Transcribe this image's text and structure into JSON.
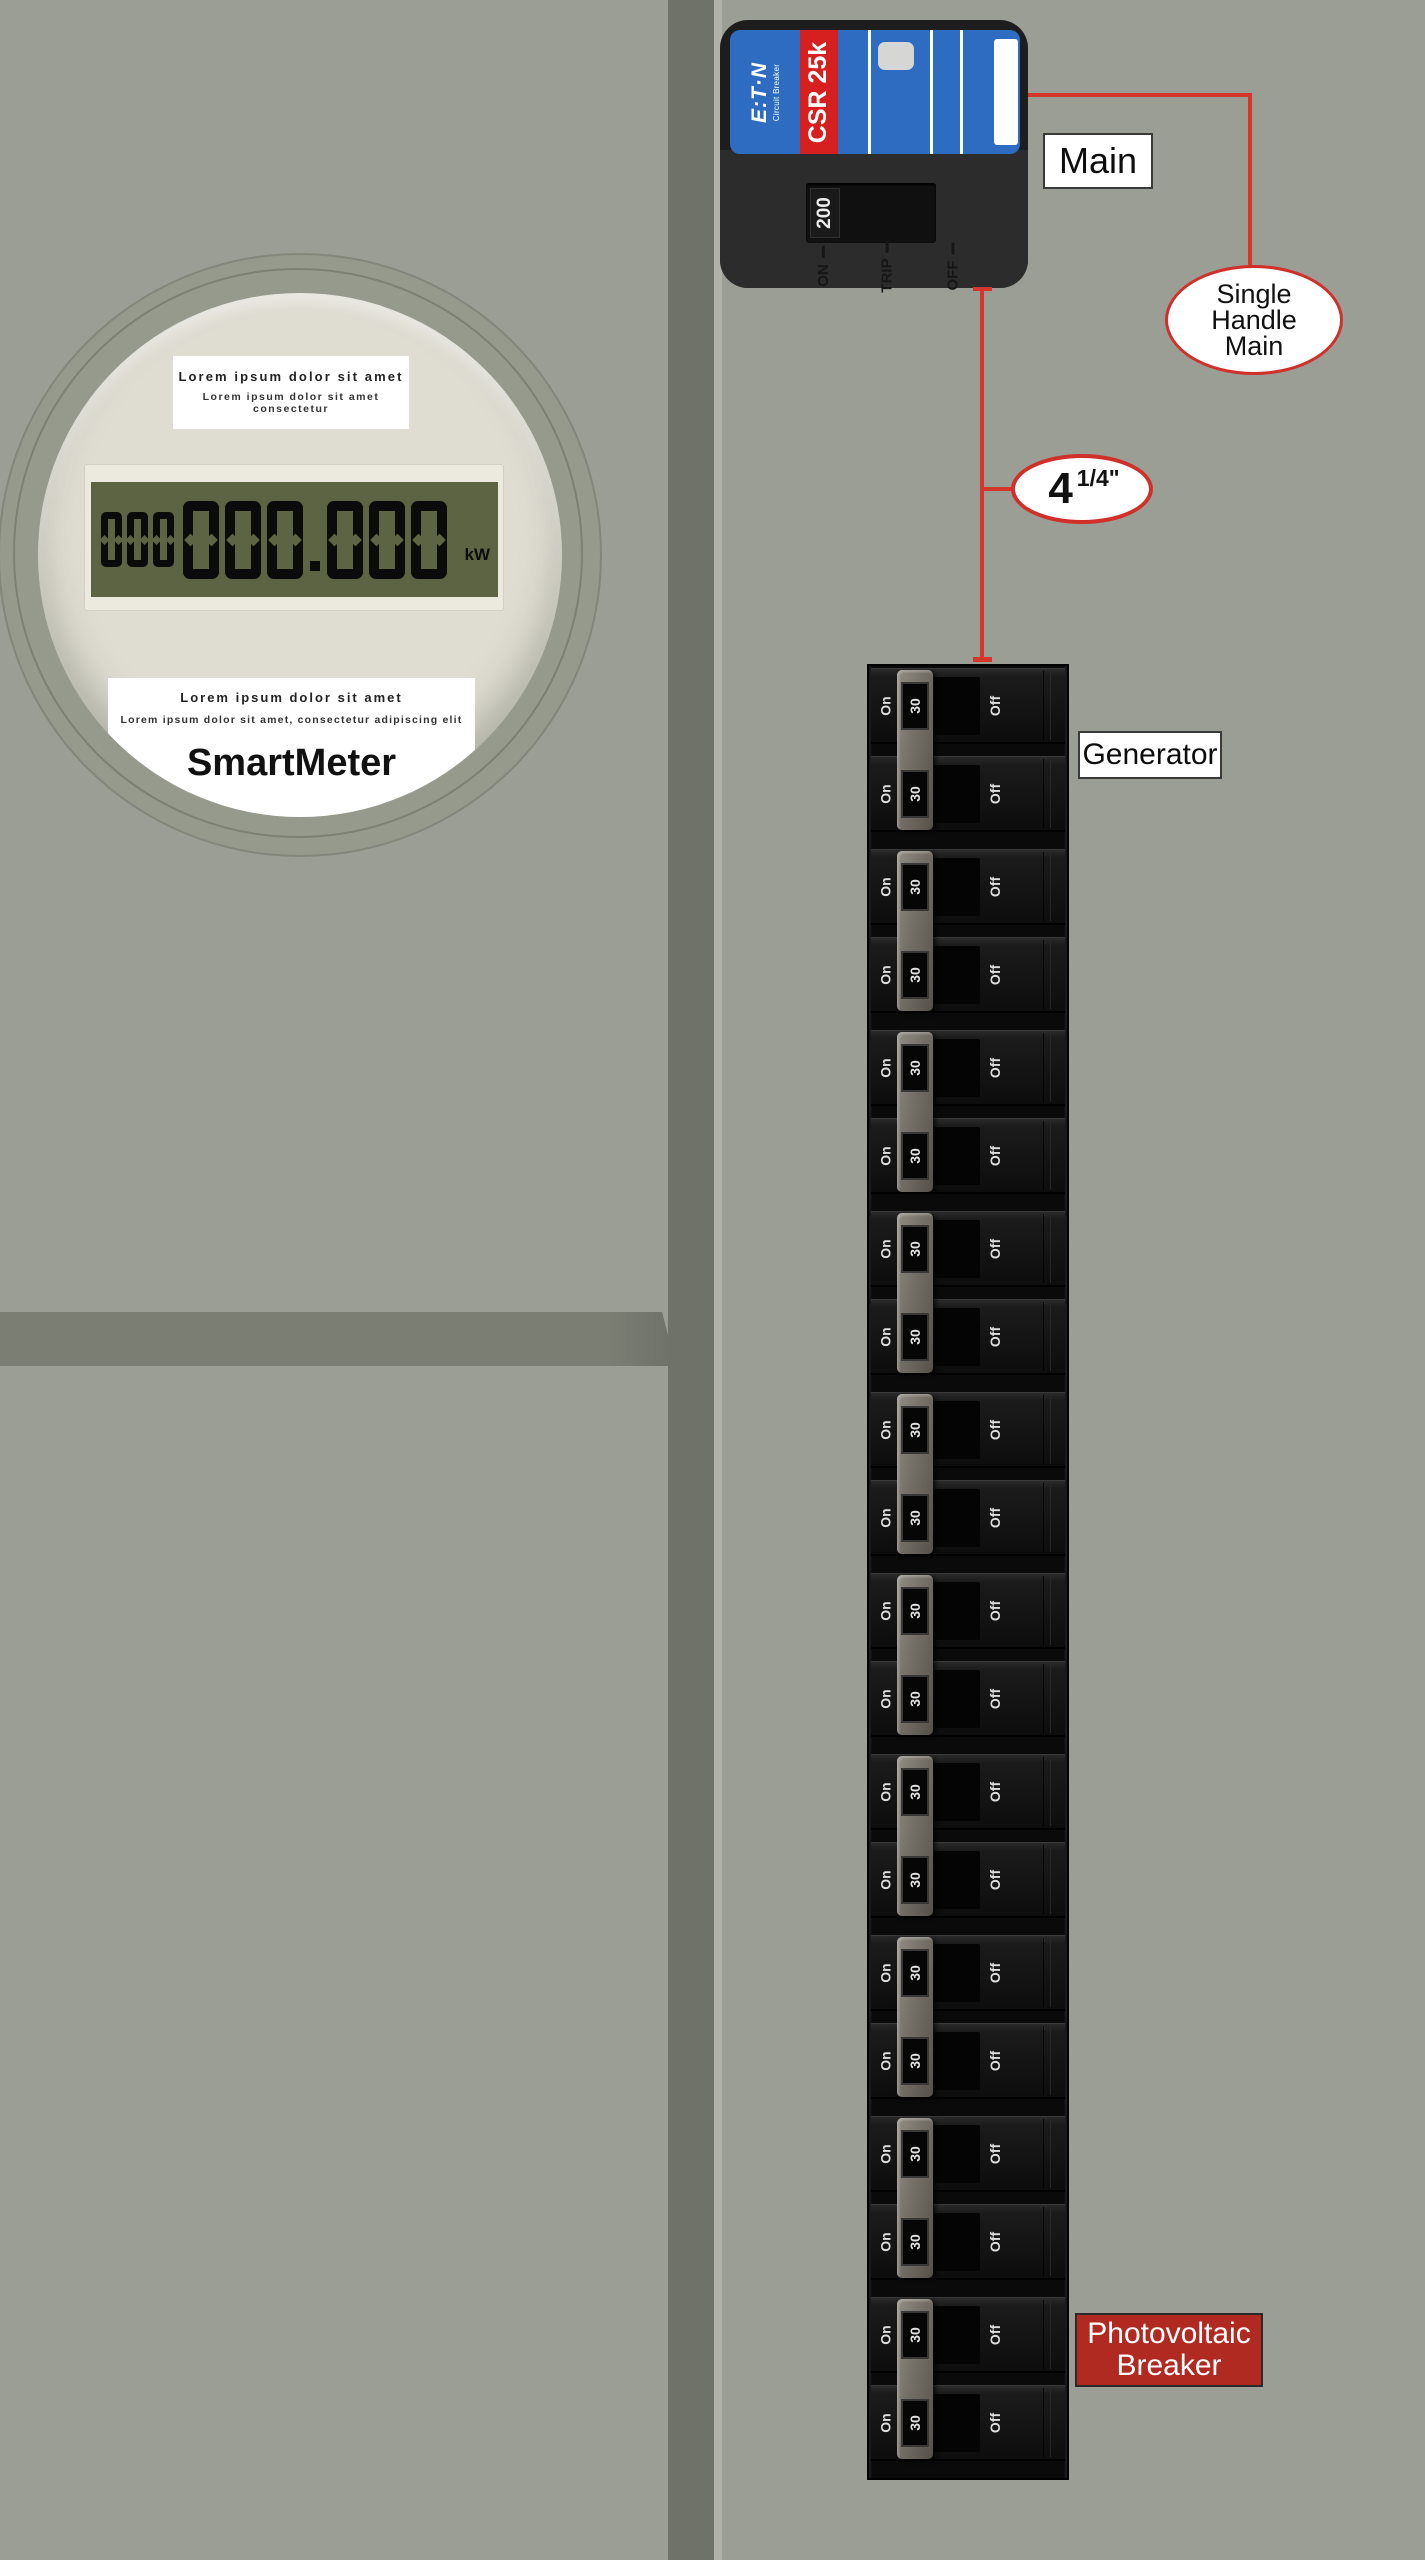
{
  "annotations": {
    "main_label": "Main",
    "single_handle_main": [
      "Single",
      "Handle",
      "Main"
    ],
    "dimension_value": "4",
    "dimension_fraction": "1/4\"",
    "generator_label": "Generator",
    "photovoltaic_label": [
      "Photovoltaic",
      "Breaker"
    ],
    "line_color": "#d6352c"
  },
  "main_breaker": {
    "brand_logo": "E:T·N",
    "brand_sub": "Circuit Breaker",
    "model": "CSR 25k",
    "rating": "200",
    "positions": [
      {
        "label": "ON"
      },
      {
        "label": "TRIP"
      },
      {
        "label": "OFF"
      }
    ],
    "label_color": "#2e6cc2",
    "stripe_color": "#d6201f"
  },
  "meter": {
    "top_card": {
      "title": "Lorem ipsum dolor sit amet",
      "subtitle": "Lorem ipsum dolor sit amet consectetur"
    },
    "lcd": {
      "small_digits": "000",
      "digits": "000.000",
      "unit": "kW",
      "screen_color": "#5d6444"
    },
    "bottom_card": {
      "title": "Lorem ipsum dolor sit amet",
      "subtitle": "Lorem ipsum dolor sit amet, consectetur adipiscing elit",
      "brand": "SmartMeter"
    }
  },
  "panel": {
    "groups": 10,
    "breaker": {
      "on": "On",
      "amp": "30",
      "off": "Off"
    }
  }
}
